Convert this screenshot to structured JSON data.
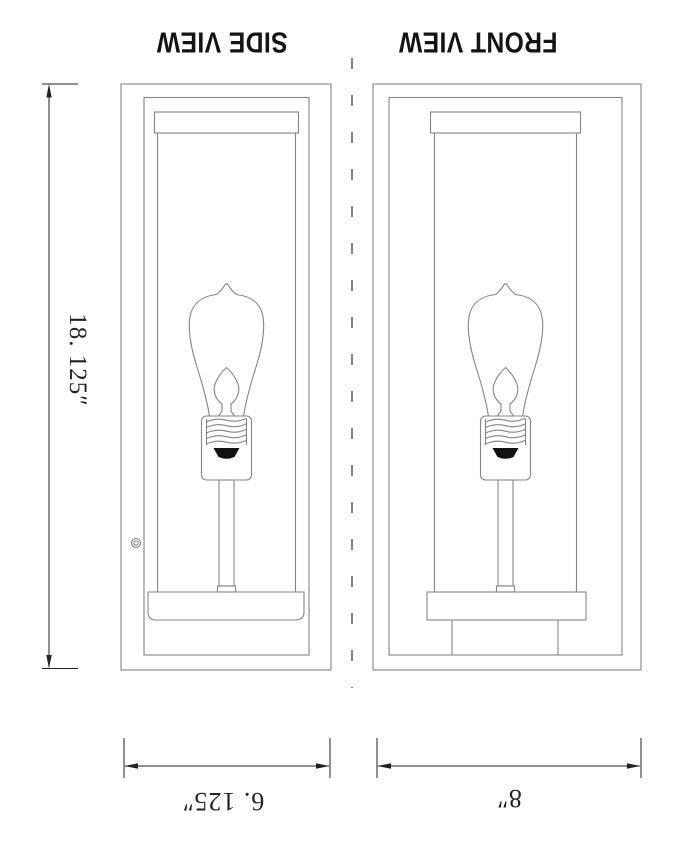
{
  "views": {
    "side": {
      "label": "SIDE VIEW",
      "width_dim": "6. 125″"
    },
    "front": {
      "label": "FRONT VIEW",
      "width_dim": "8″"
    }
  },
  "dimensions": {
    "height": "18. 125″"
  },
  "colors": {
    "background": "#ffffff",
    "drawing_line": "#858585",
    "dimension_line": "#222222",
    "text": "#141414"
  }
}
